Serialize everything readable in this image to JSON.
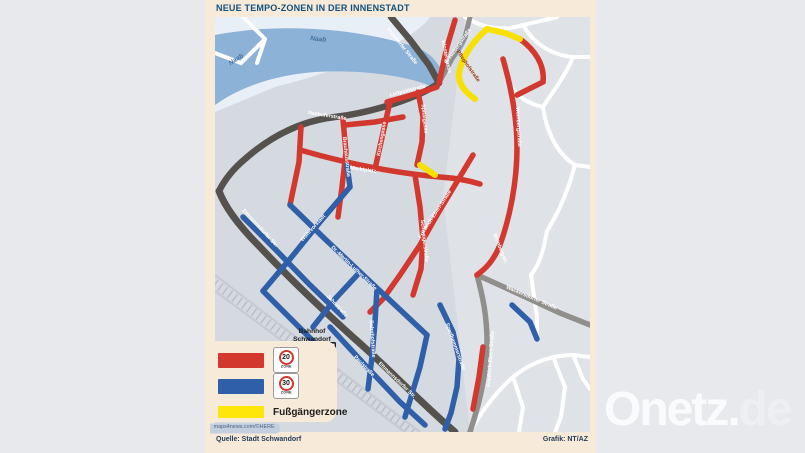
{
  "header": {
    "title": "NEUE TEMPO-ZONEN IN DER INNENSTADT"
  },
  "footer": {
    "source": "Quelle: Stadt Schwandorf",
    "credit": "Grafik: NT/AZ"
  },
  "branding": {
    "main": "Onetz.",
    "suffix": "de"
  },
  "colors": {
    "zone20_red": "#d2382e",
    "zone30_blue": "#2e5fa8",
    "pedestrian_yellow": "#ffe60a",
    "river_blue": "#8cb2d8",
    "frame_peach": "#f8ead9",
    "title_navy": "#11507e"
  },
  "legend": {
    "rows": [
      {
        "type": "sign",
        "swatch": "#d2382e",
        "value": "20",
        "zone_word": "ZONE"
      },
      {
        "type": "sign",
        "swatch": "#2e5fa8",
        "value": "30",
        "zone_word": "ZONE"
      },
      {
        "type": "text",
        "swatch": "#ffe60a",
        "label": "Fußgängerzone"
      }
    ],
    "watermark": "maps4news.com/©HERE"
  },
  "map": {
    "station_line1": "Bahnhof",
    "station_line2": "Schwandorf",
    "street_labels": [
      {
        "t": "Naab",
        "x": 22,
        "y": 44,
        "r": -33,
        "c": "water"
      },
      {
        "t": "Naab",
        "x": 103,
        "y": 24,
        "r": 6,
        "c": "water"
      },
      {
        "t": "Krondorfer Straße",
        "x": 186,
        "y": 30,
        "r": 51,
        "c": "dark"
      },
      {
        "t": "Kreuzbergstraße",
        "x": 244,
        "y": 30,
        "r": -55,
        "c": "dark"
      },
      {
        "t": "Naabuferstraße",
        "x": 112,
        "y": 100,
        "r": 9,
        "c": "dark"
      },
      {
        "t": "Ettmannsdorfer Str.",
        "x": 44,
        "y": 212,
        "r": 47,
        "c": "dark"
      },
      {
        "t": "Ettmannsdorfer Str.",
        "x": 181,
        "y": 364,
        "r": 44,
        "c": "dark"
      },
      {
        "t": "Friedrich-Ebert-Straße",
        "x": 277,
        "y": 342,
        "r": -86,
        "c": "grey"
      },
      {
        "t": "Wackersdorfer Straße",
        "x": 316,
        "y": 282,
        "r": 23,
        "c": "grey"
      },
      {
        "t": "Klostergasse",
        "x": 230,
        "y": 40,
        "r": 78,
        "c": "red"
      },
      {
        "t": "Luitpoldstraße",
        "x": 193,
        "y": 75,
        "r": -14,
        "c": "red"
      },
      {
        "t": "Spitalgasse",
        "x": 208,
        "y": 102,
        "r": 84,
        "c": "red"
      },
      {
        "t": "Kirchengasse",
        "x": 168,
        "y": 122,
        "r": -80,
        "c": "red"
      },
      {
        "t": "Brauhausstraße",
        "x": 130,
        "y": 140,
        "r": 84,
        "c": "red"
      },
      {
        "t": "Marktplatz",
        "x": 148,
        "y": 154,
        "r": 8,
        "c": "red"
      },
      {
        "t": "Schwaigerstraße",
        "x": 208,
        "y": 224,
        "r": 84,
        "c": "red"
      },
      {
        "t": "Friedrich-Ebert-Straße",
        "x": 221,
        "y": 198,
        "r": -57,
        "c": "red"
      },
      {
        "t": "Weinbergstraße",
        "x": 302,
        "y": 110,
        "r": 87,
        "c": "red"
      },
      {
        "t": "Weinbergstr.",
        "x": 284,
        "y": 232,
        "r": 68,
        "c": "red"
      },
      {
        "t": "Pfleghofstraße",
        "x": 252,
        "y": 50,
        "r": 55,
        "c": "yellow"
      },
      {
        "t": "Wöhrvorstadt",
        "x": 99,
        "y": 212,
        "r": -48,
        "c": "blue"
      },
      {
        "t": "Dr.-Martin-Luther-Straße",
        "x": 138,
        "y": 252,
        "r": 44,
        "c": "blue"
      },
      {
        "t": "Jahnstraße",
        "x": 121,
        "y": 290,
        "r": 48,
        "c": "blue"
      },
      {
        "t": "Bahnhofstraße",
        "x": 156,
        "y": 322,
        "r": 86,
        "c": "blue"
      },
      {
        "t": "Sperlhammerstraße",
        "x": 239,
        "y": 330,
        "r": 70,
        "c": "blue"
      },
      {
        "t": "Paulstraße",
        "x": 148,
        "y": 350,
        "r": 46,
        "c": "blue"
      }
    ]
  }
}
